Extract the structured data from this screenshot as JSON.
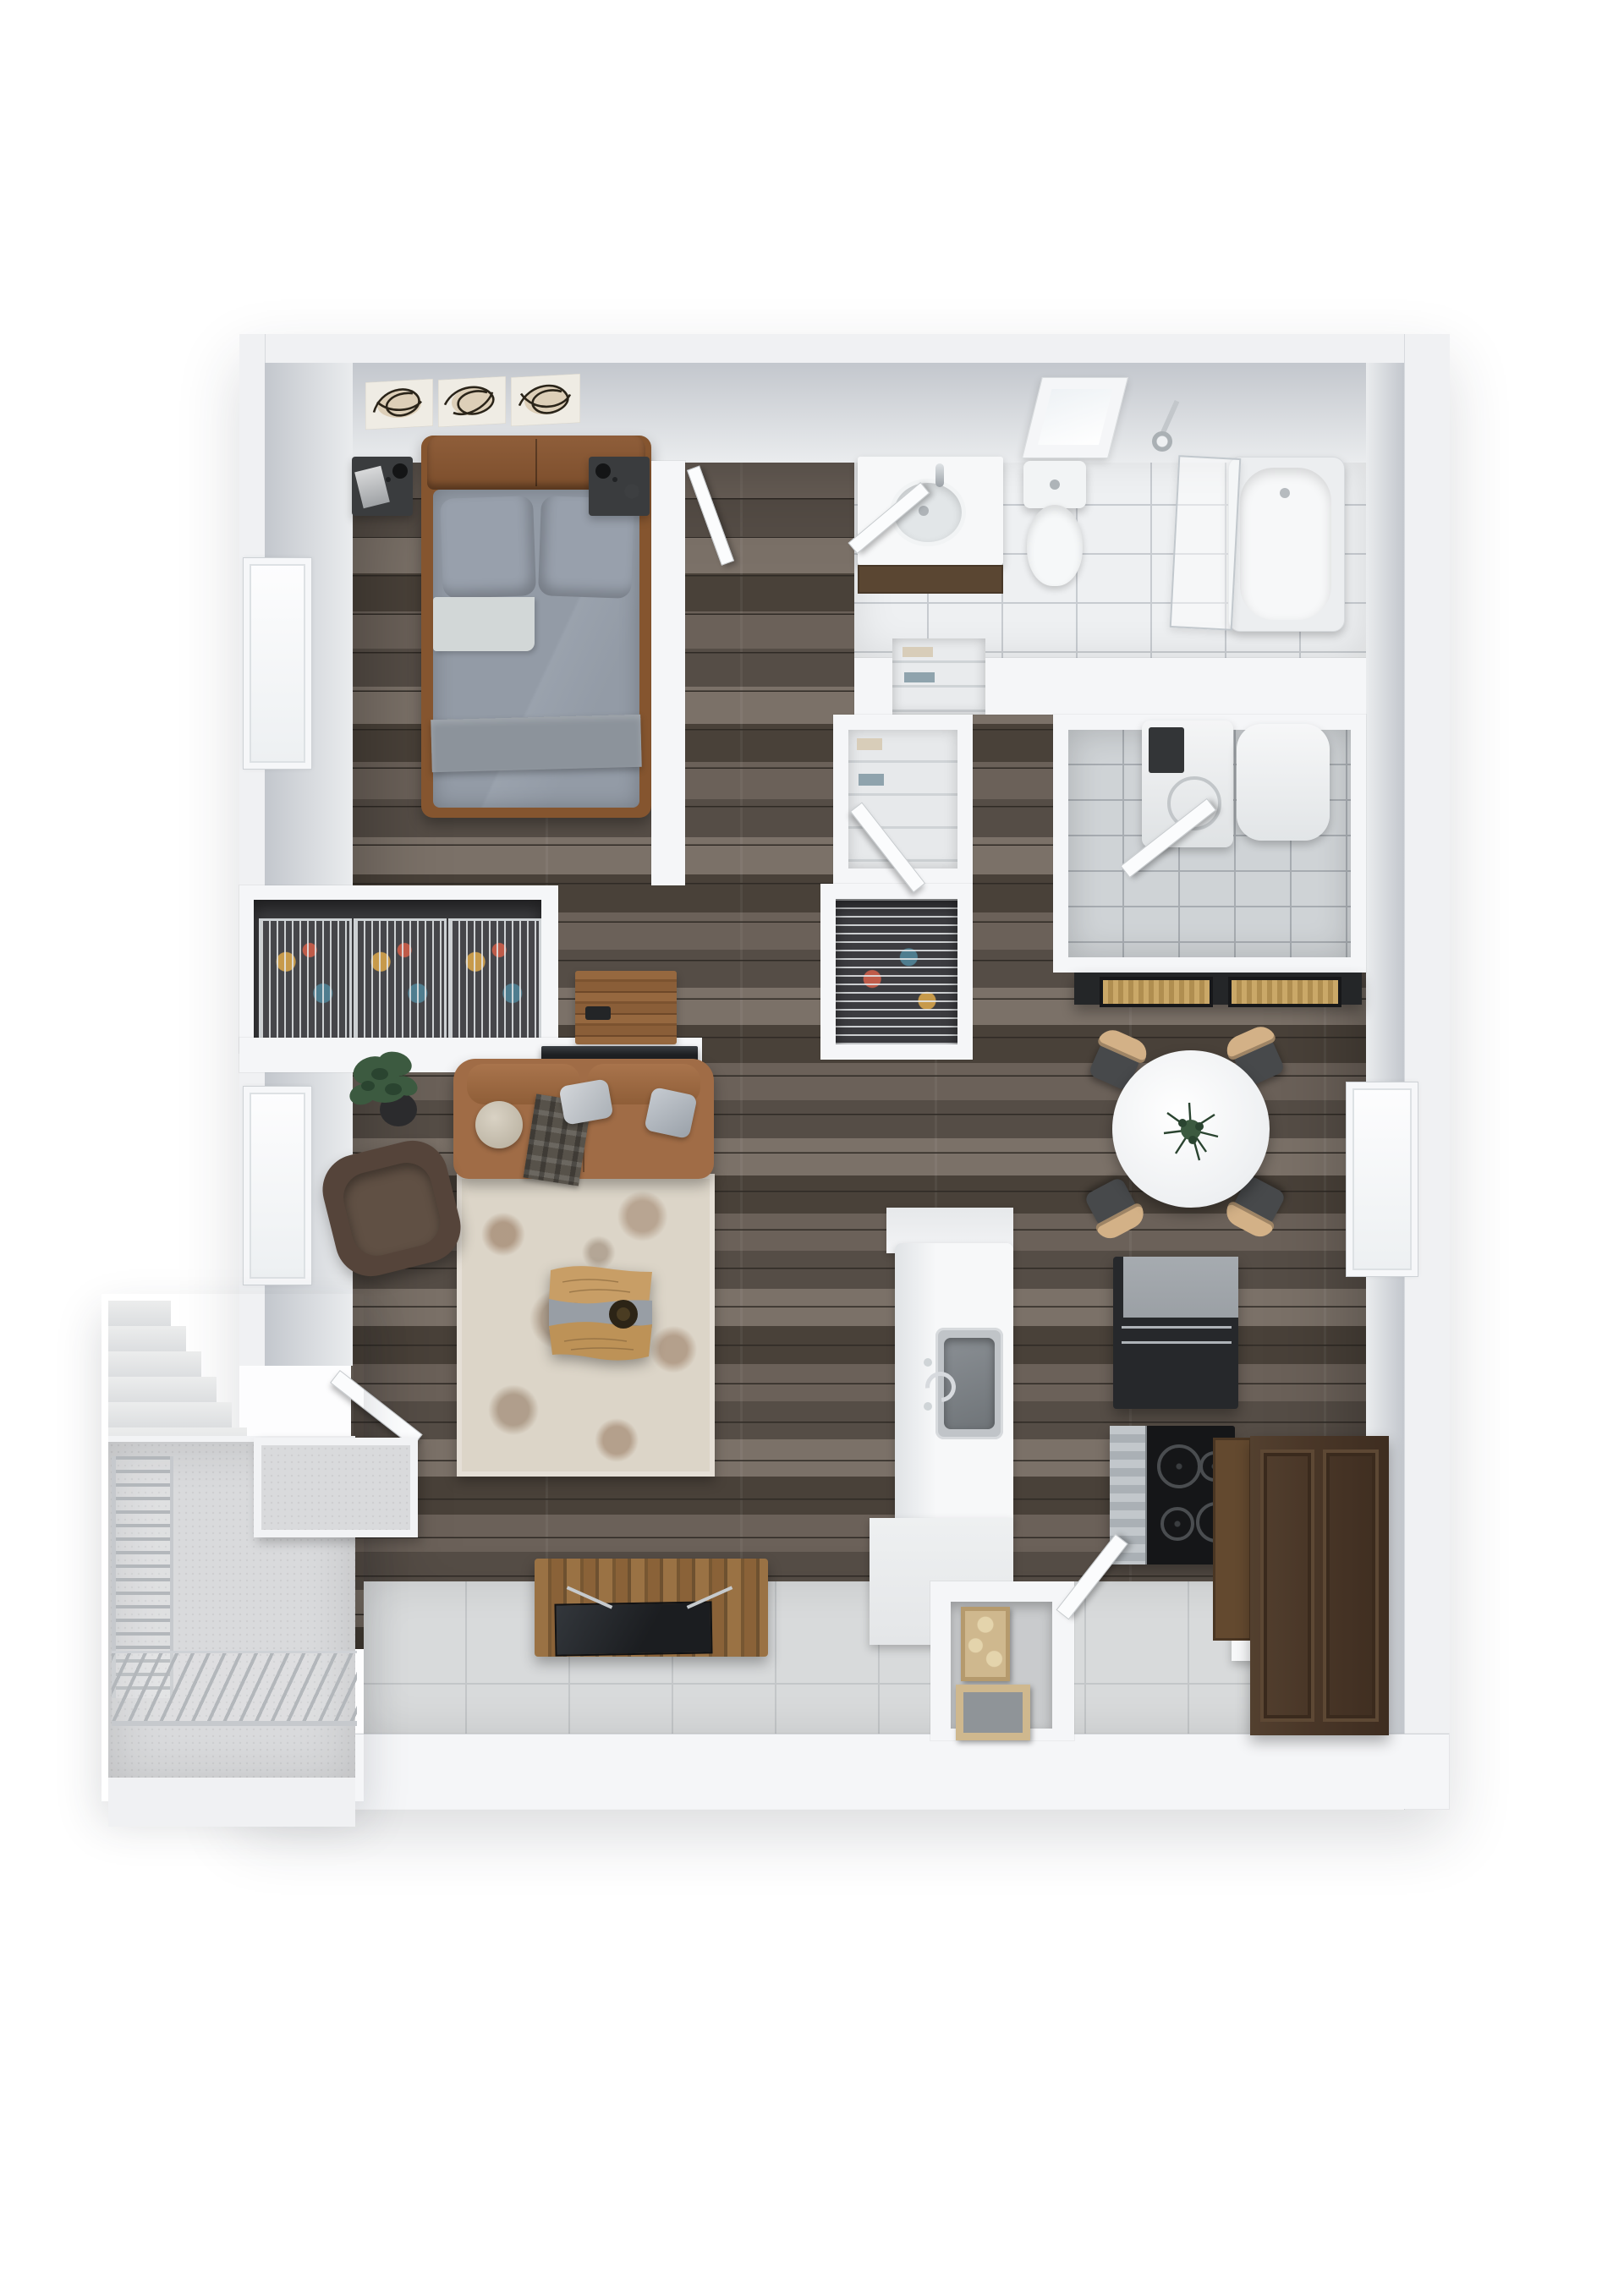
{
  "meta": {
    "view": "3d-top-down-apartment-floor-plan",
    "visible_text": "none"
  },
  "colors": {
    "wall-outer": "#f0f1f3",
    "wall-face": "#c3c7cd",
    "wall-face-light": "#eaecee",
    "partition": "#f5f6f8",
    "wood-a": "#6b6159",
    "wood-b": "#554d46",
    "wood-c": "#7b7168",
    "wood-d": "#494139",
    "wood-gap": "#2f2a25",
    "tile-bath": "#eef0f2",
    "grout-bath": "#c7cbd0",
    "tile-laundry": "#cfd3d6",
    "grout-laundry": "#a7acb1",
    "tile-kitchen": "#d8dadb",
    "grout-kitchen": "#c3c6c8",
    "concrete": "#d9dadc",
    "railing": "#b3b7bb",
    "leather": "#a06c46",
    "leather-dark": "#85552f",
    "armchair": "#55443a",
    "headboard": "#8a5a38",
    "duvet": "#939ba6",
    "pillow": "#98a0ac",
    "sheet": "#d2d7d7",
    "blanket": "#8c939b",
    "rug": "#dcd5c8",
    "rug-spot": "#8d6b50",
    "table-wood": "#c89e66",
    "resin": "#989ea5",
    "tv": "#1e2023",
    "steel": "#c0c4c8",
    "steel-dark": "#7c8185",
    "fridge": "#26282b",
    "fridge-top": "#9ba0a5",
    "cooktop": "#151618",
    "pantry": "#4a3728",
    "pantry-light": "#63492f",
    "lemon": "#e6df35",
    "plant": "#3c5a40",
    "plant-dark": "#2a4430",
    "tan": "#d3b187",
    "seat": "#47494b",
    "wire": "#cdd1d4",
    "console-wood": "#9a7244",
    "console-wood-dark": "#775732",
    "alcove-wood": "#cfb88e",
    "white-top": "#f7f8f9",
    "cloth-1": "#bf5b49",
    "cloth-2": "#4f7d8f",
    "cloth-3": "#c79a4b",
    "towel-1": "#d8cdb9",
    "towel-2": "#8fa3ad"
  },
  "legend": {
    "rooms": [
      {
        "name": "bedroom",
        "items": [
          "bed",
          "headboard",
          "pillows",
          "nightstand-left",
          "nightstand-right",
          "wall-art-triptych",
          "window"
        ]
      },
      {
        "name": "bathroom",
        "items": [
          "vanity-sink",
          "toilet",
          "bathtub",
          "glass-screen",
          "shower-head",
          "skylight"
        ]
      },
      {
        "name": "laundry-room",
        "items": [
          "washer",
          "water-heater",
          "door"
        ]
      },
      {
        "name": "closets",
        "items": [
          "wire-basket-closet",
          "coat-closet",
          "linen-niche",
          "hall-closet",
          "dresser"
        ]
      },
      {
        "name": "living-room",
        "items": [
          "leather-sofa",
          "throw-pillows",
          "armchair",
          "potted-plant",
          "area-rug",
          "live-edge-coffee-table",
          "tv",
          "media-console",
          "patio-door"
        ]
      },
      {
        "name": "dining-area",
        "items": [
          "round-table",
          "centerpiece-plant",
          "four-chairs",
          "dark-console",
          "window"
        ]
      },
      {
        "name": "kitchen",
        "items": [
          "island-with-sink",
          "refrigerator",
          "range-cooktop",
          "oven-door",
          "lemon-bowl-counter",
          "pantry-cabinet",
          "alcove-chair",
          "entry-door"
        ]
      },
      {
        "name": "balcony",
        "items": [
          "concrete-slab",
          "metal-railing",
          "staircase",
          "storage-box"
        ]
      }
    ]
  }
}
